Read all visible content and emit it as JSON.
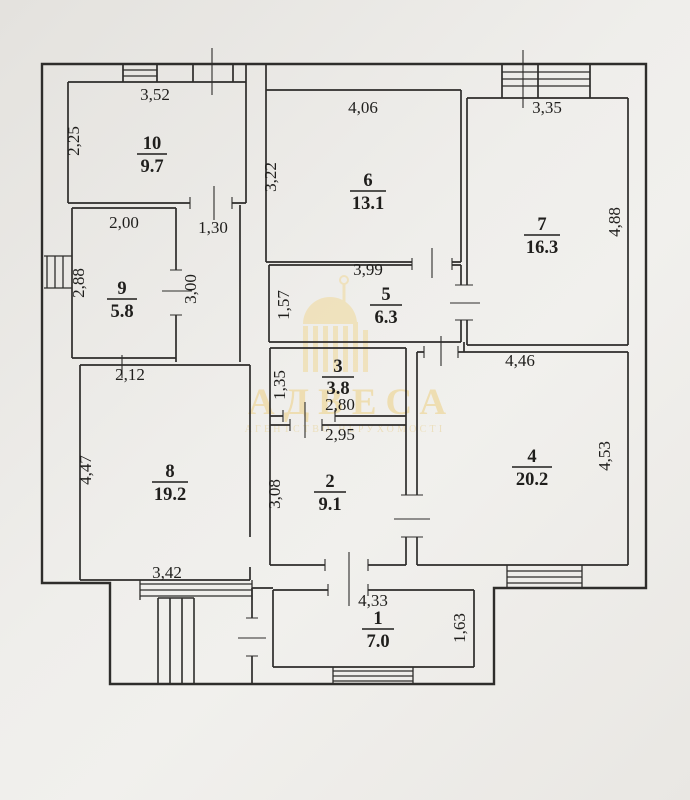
{
  "document": {
    "kind": "floor-plan-scan"
  },
  "watermark": {
    "brand": "АДВЕСА",
    "subtitle": "АГЕНТСТВО НЕРУХОМОСТІ",
    "color": "#eed9a2"
  },
  "rooms": {
    "r1": {
      "number": "1",
      "area": "7.0",
      "dim_top": "4,33",
      "dim_right": "1,63"
    },
    "r2": {
      "number": "2",
      "area": "9.1",
      "dim_top": "2,95",
      "dim_left": "3,08"
    },
    "r3": {
      "number": "3",
      "area": "3.8",
      "dim_left": "1,35",
      "dim_bottom": "2,80"
    },
    "r4": {
      "number": "4",
      "area": "20.2",
      "dim_top": "4,46",
      "dim_right": "4,53"
    },
    "r5": {
      "number": "5",
      "area": "6.3",
      "dim_top": "3,99",
      "dim_left": "1,57"
    },
    "r6": {
      "number": "6",
      "area": "13.1",
      "dim_top": "4,06",
      "dim_left": "3,22"
    },
    "r7": {
      "number": "7",
      "area": "16.3",
      "dim_top": "3,35",
      "dim_right": "4,88"
    },
    "r8": {
      "number": "8",
      "area": "19.2",
      "dim_top": "2,12",
      "dim_left": "4,47",
      "dim_bottom": "3,42"
    },
    "r9": {
      "number": "9",
      "area": "5.8",
      "dim_top": "2,00",
      "dim_left": "2,88"
    },
    "r10": {
      "number": "10",
      "area": "9.7",
      "dim_top": "3,52",
      "dim_left": "2,25"
    },
    "corridor": {
      "dim_top": "1,30",
      "dim_right": "3,00"
    }
  }
}
